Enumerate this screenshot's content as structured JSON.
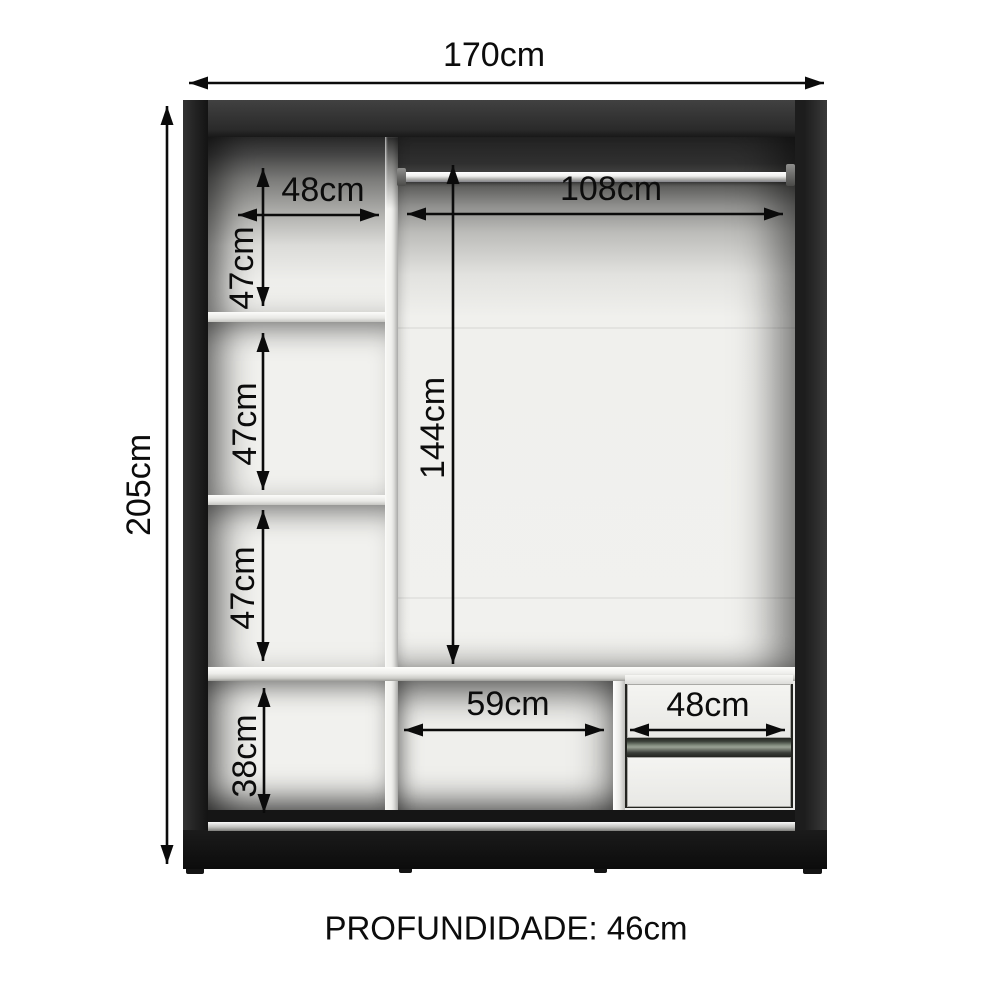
{
  "diagram": {
    "labels": {
      "total_width": "170cm",
      "total_height": "205cm",
      "left_column_width": "48cm",
      "compartment1_height": "47cm",
      "compartment2_height": "47cm",
      "compartment3_height": "47cm",
      "bottom_left_height": "38cm",
      "hanging_width": "108cm",
      "hanging_height": "144cm",
      "bottom_middle_width": "59cm",
      "drawer_width": "48cm",
      "depth_note": "PROFUNDIDADE: 46cm"
    },
    "colors": {
      "background": "#ffffff",
      "frame": "#1c1c1c",
      "panel": "#f1f1ee",
      "dimension_lines": "#0b0b0b",
      "rail_silver": "#c3c3c0"
    }
  }
}
